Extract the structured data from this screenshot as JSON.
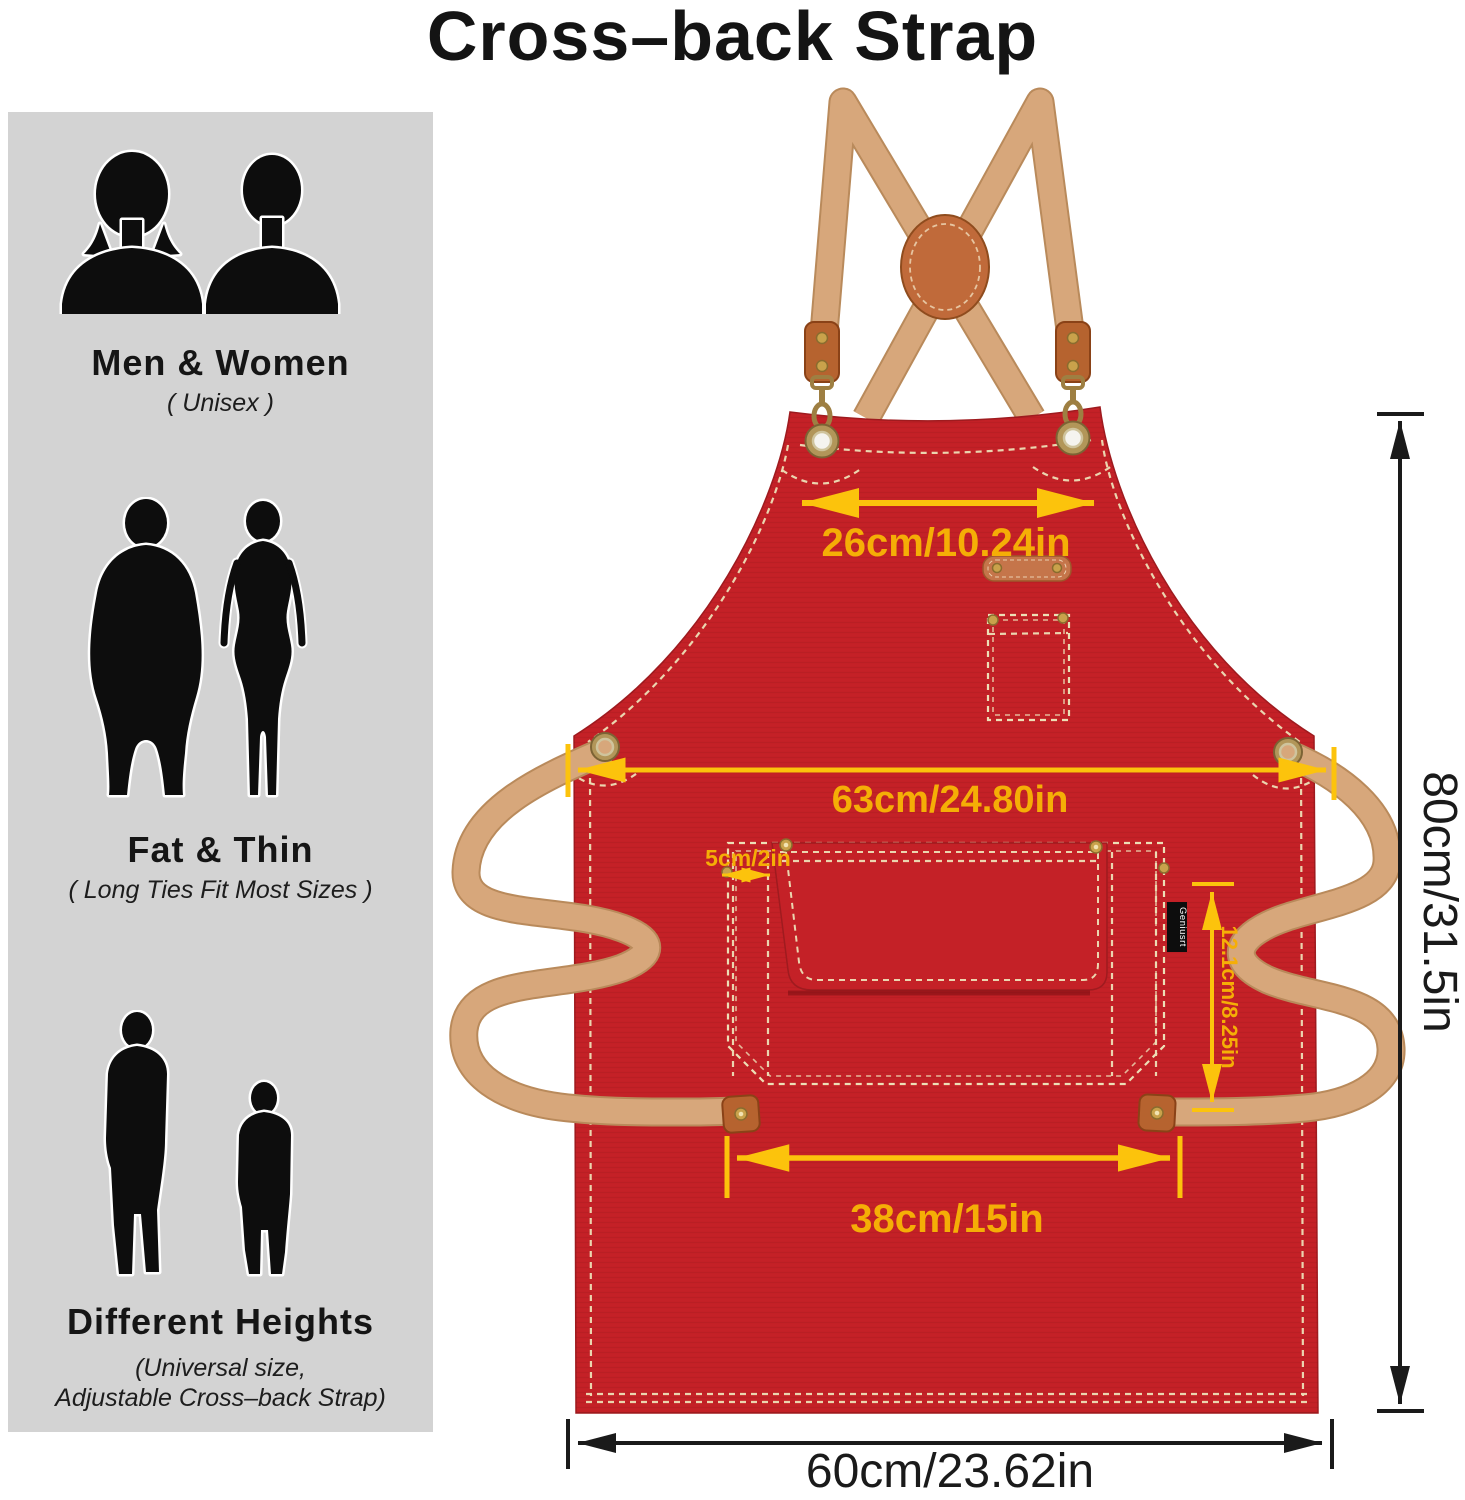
{
  "title": "Cross–back Strap",
  "sidebar": {
    "sections": [
      {
        "heading": "Men & Women",
        "subheading": "( Unisex )"
      },
      {
        "heading": "Fat & Thin",
        "subheading": "( Long Ties Fit Most Sizes )"
      },
      {
        "heading": "Different Heights",
        "subheading_line1": "(Universal size,",
        "subheading_line2": "Adjustable Cross–back Strap)"
      }
    ]
  },
  "apron": {
    "brand_tag": "Geniusrt",
    "dimensions": {
      "neck_strap_width": "26cm/10.24in",
      "chest_width": "63cm/24.80in",
      "side_slot_width": "5cm/2in",
      "pocket_height": "12.1cm/8.25in",
      "pocket_width": "38cm/15in",
      "apron_length": "80cm/31.5in",
      "bottom_width": "60cm/23.62in"
    },
    "colors": {
      "canvas_red": "#c42127",
      "strap_tan": "#d7a77b",
      "leather_brown": "#b6632f",
      "dimension_yellow": "#fcc30c",
      "dimension_black": "#1a1a1a",
      "panel_gray": "#d3d3d3"
    }
  }
}
